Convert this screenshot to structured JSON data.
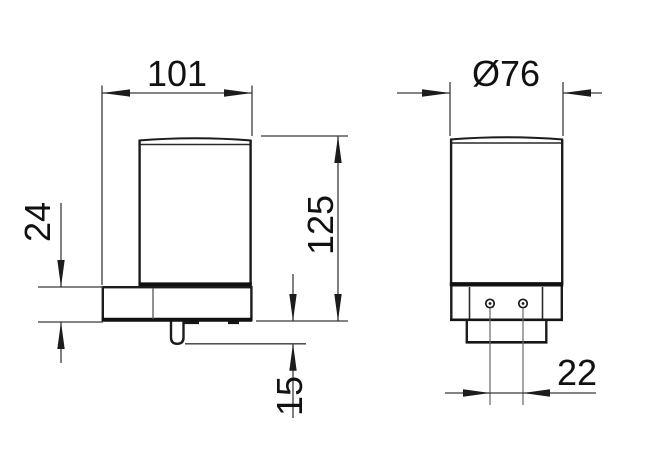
{
  "drawing": {
    "type": "technical-dimension-drawing",
    "subject": "wall-mounted soap dispenser, two orthographic views",
    "colors": {
      "background": "#ffffff",
      "line": "#1c1c1c",
      "thick_line": "#111111",
      "dim_line": "#3a3a3a",
      "center_line": "#666666",
      "text": "#111111"
    },
    "side_view": {
      "dims": {
        "width": "101",
        "height": "125",
        "plate_height": "24",
        "spout_length": "15"
      }
    },
    "front_view": {
      "dims": {
        "diameter": "Ø76",
        "hole_spacing": "22"
      }
    }
  }
}
